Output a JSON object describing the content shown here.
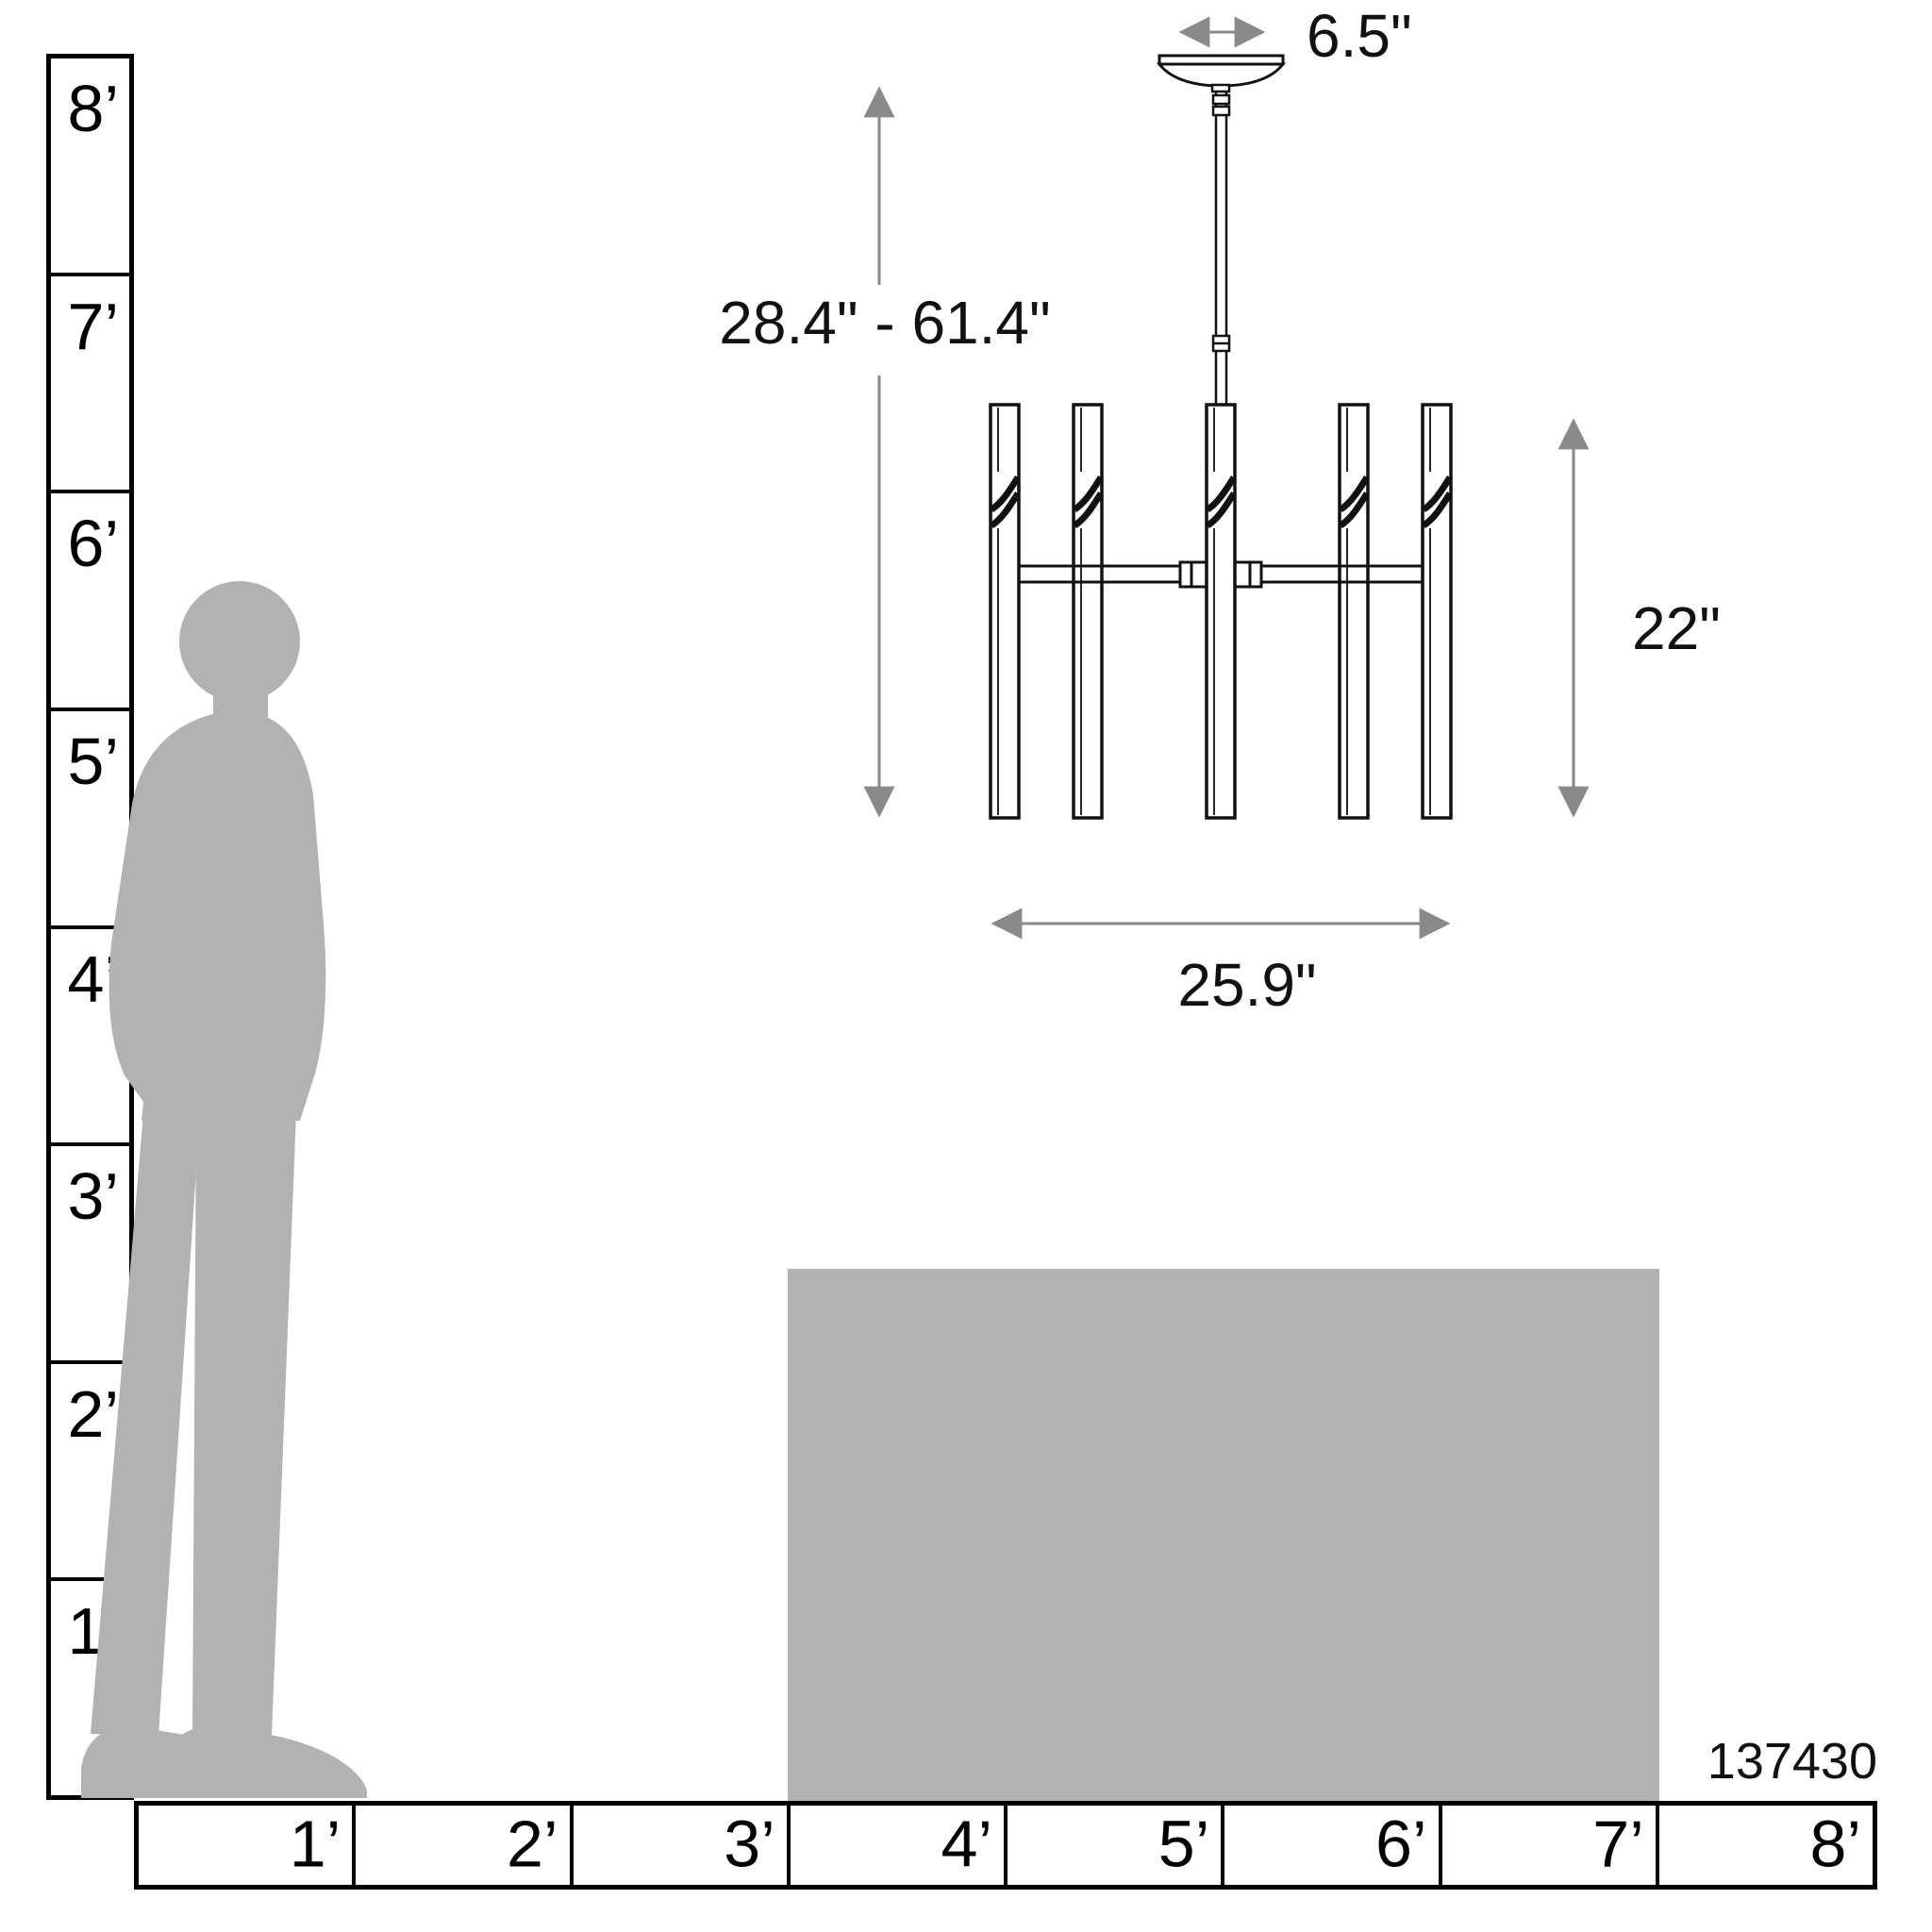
{
  "product": {
    "number": "137430"
  },
  "dimensions": {
    "canopy_width": "6.5\"",
    "hanging_height_range": "28.4\" - 61.4\"",
    "fixture_height": "22\"",
    "fixture_width": "25.9\""
  },
  "rulers": {
    "vertical": {
      "unit": "feet",
      "labels": [
        {
          "label": "8’"
        },
        {
          "label": "7’"
        },
        {
          "label": "6’"
        },
        {
          "label": "5’"
        },
        {
          "label": "4’"
        },
        {
          "label": "3’"
        },
        {
          "label": "2’"
        },
        {
          "label": "1’"
        }
      ]
    },
    "horizontal": {
      "unit": "feet",
      "labels": [
        {
          "label": "1’"
        },
        {
          "label": "2’"
        },
        {
          "label": "3’"
        },
        {
          "label": "4’"
        },
        {
          "label": "5’"
        },
        {
          "label": "6’"
        },
        {
          "label": "7’"
        },
        {
          "label": "8’"
        }
      ]
    }
  },
  "colors": {
    "silhouette": "#b2b2b2",
    "table": "#b2b2b2",
    "line_art": "#111111",
    "dimension_line": "#8a8a8a"
  }
}
